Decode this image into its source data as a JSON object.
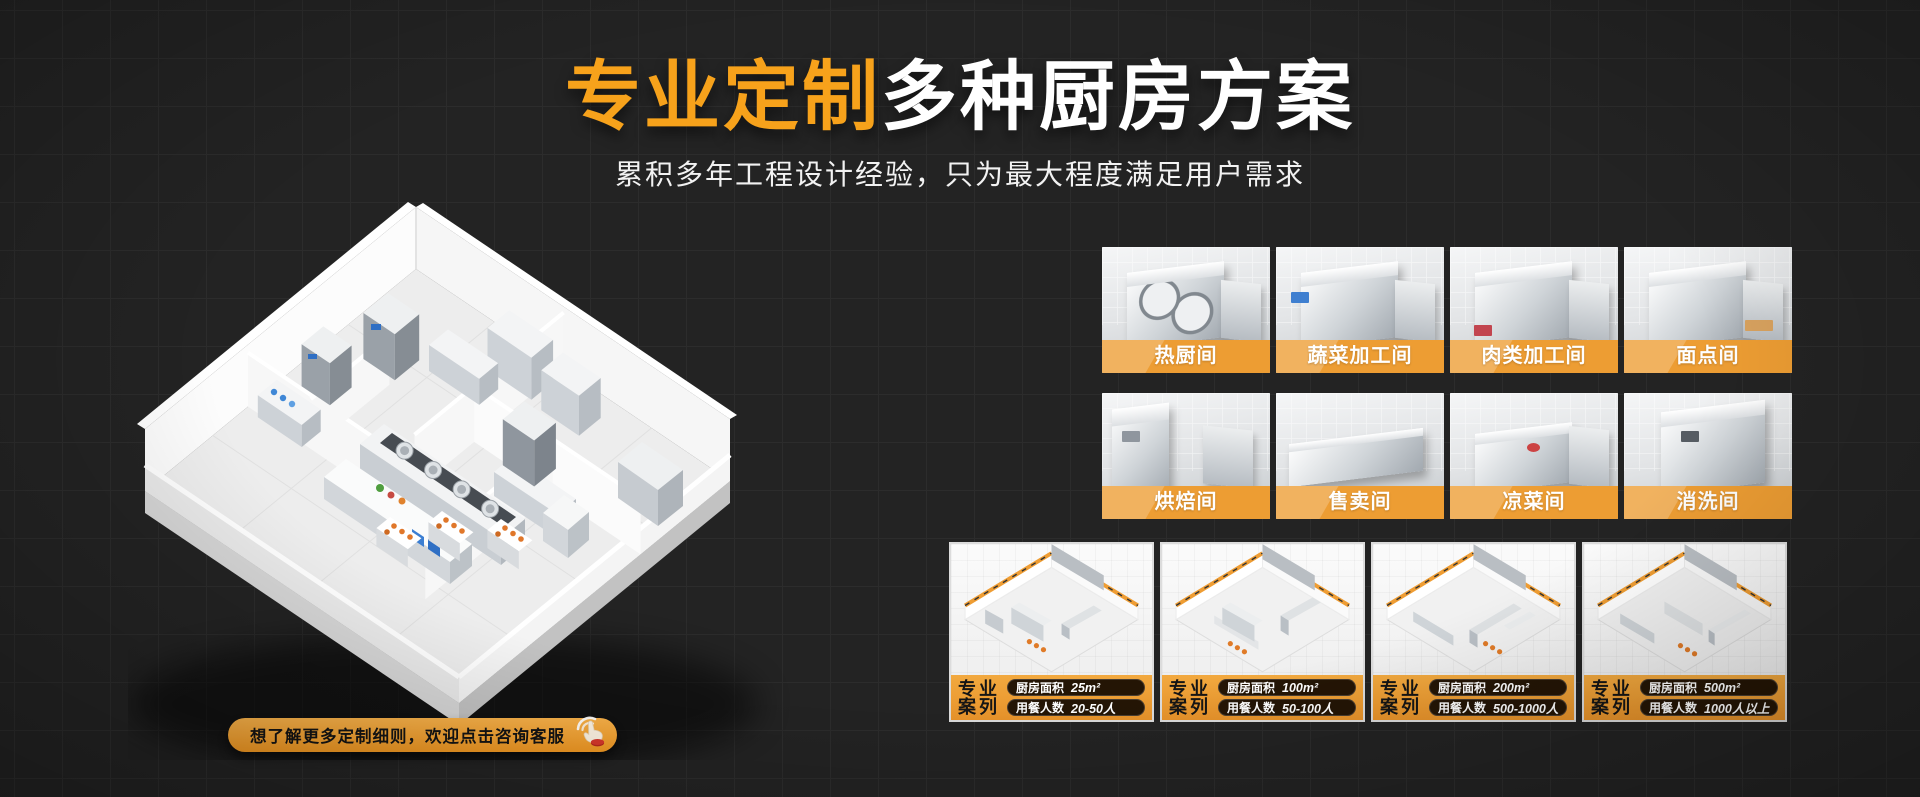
{
  "theme": {
    "background": "#232323",
    "grid_line": "#2c2c2c",
    "title_orange": "#F7A21B",
    "banner_orange": "#ED9D33",
    "cta_orange": "#F2A02C",
    "pill_dark": "#241505",
    "text_white": "#FFFFFF"
  },
  "hero": {
    "title_highlight": "专业定制",
    "title_rest": "多种厨房方案",
    "subtitle": "累积多年工程设计经验，只为最大程度满足用户需求"
  },
  "cta": {
    "label": "想了解更多定制细则，欢迎点击咨询客服",
    "icon": "click-hand-icon"
  },
  "floorplan": {
    "illustration": "isometric-3d-kitchen-floorplan"
  },
  "rooms": {
    "items": [
      {
        "label": "热厨间"
      },
      {
        "label": "蔬菜加工间"
      },
      {
        "label": "肉类加工间"
      },
      {
        "label": "面点间"
      },
      {
        "label": "烘焙间"
      },
      {
        "label": "售卖间"
      },
      {
        "label": "凉菜间"
      },
      {
        "label": "消洗间"
      }
    ]
  },
  "cases": {
    "badge_line1": "专业",
    "badge_line2": "案列",
    "items": [
      {
        "area_label": "厨房面积",
        "area_value": "25m²",
        "diners_label": "用餐人数",
        "diners_value": "20-50人"
      },
      {
        "area_label": "厨房面积",
        "area_value": "100m²",
        "diners_label": "用餐人数",
        "diners_value": "50-100人"
      },
      {
        "area_label": "厨房面积",
        "area_value": "200m²",
        "diners_label": "用餐人数",
        "diners_value": "500-1000人"
      },
      {
        "area_label": "厨房面积",
        "area_value": "500m²",
        "diners_label": "用餐人数",
        "diners_value": "1000人以上"
      }
    ]
  }
}
